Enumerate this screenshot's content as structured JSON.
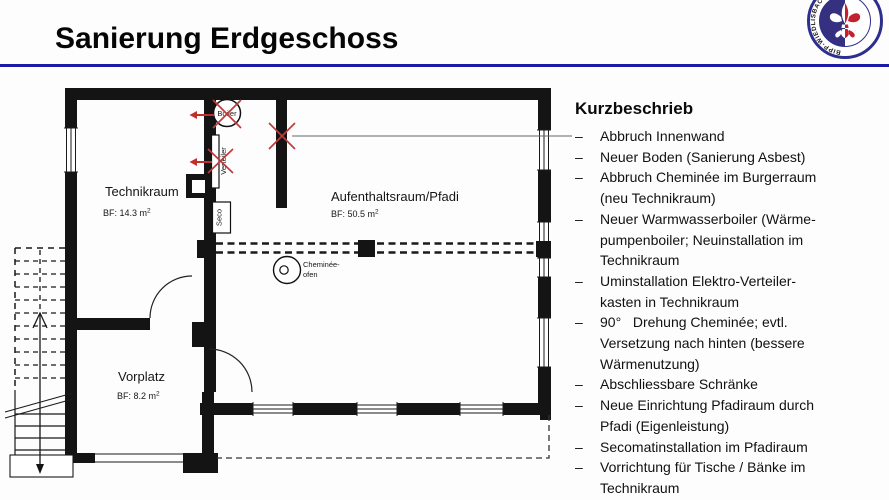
{
  "slide": {
    "title": "Sanierung Erdgeschoss"
  },
  "logo": {
    "ring_text": "BIPP-WIEDLISBACH"
  },
  "list": {
    "heading": "Kurzbeschrieb",
    "bullet": "–",
    "items": [
      "Abbruch Innenwand",
      "Neuer Boden (Sanierung Asbest)",
      "Abbruch Cheminée im Burgerraum\n(neu Technikraum)",
      "Neuer Warmwasserboiler (Wärme-\npumpenboiler; Neuinstallation im\nTechnikraum",
      "Uminstallation Elektro-Verteiler-\nkasten in Technikraum",
      "90°   Drehung Cheminée; evtl.\nVersetzung nach hinten (bessere\nWärmenutzung)",
      "Abschliessbare Schränke",
      "Neue Einrichtung Pfadiraum durch\nPfadi (Eigenleistung)",
      "Secomatinstallation im Pfadiraum",
      "Vorrichtung für Tische / Bänke im\nTechnikraum"
    ]
  },
  "plan": {
    "rooms": [
      {
        "name": "Technikraum",
        "area": "BF: 14.3 m",
        "area_sup": "2"
      },
      {
        "name": "Aufenthaltsraum/Pfadi",
        "area": "BF: 50.5 m",
        "area_sup": "2"
      },
      {
        "name": "Vorplatz",
        "area": "BF: 8.2 m",
        "area_sup": "2"
      }
    ],
    "equipment": {
      "boiler": "Boiler",
      "verteiler": "Verteiler",
      "seco": "Seco",
      "cheminee_line1": "Cheminée-",
      "cheminee_line2": "ofen"
    }
  },
  "colors": {
    "rule_navy": "#1b1ba8",
    "wall_black": "#141414",
    "mark_red": "#bf3a3a",
    "logo_blue": "#2d2f8e",
    "logo_fill_blue": "#35307f",
    "fleur_red": "#c22030"
  }
}
